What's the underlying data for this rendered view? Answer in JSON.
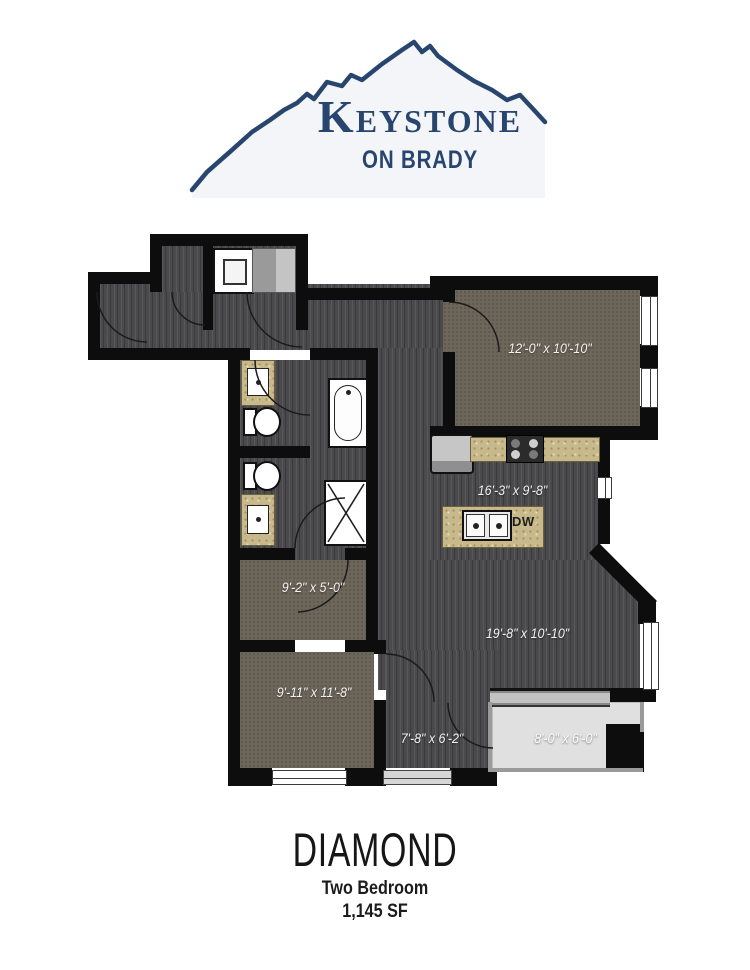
{
  "logo": {
    "name": "Keystone",
    "subtitle": "ON BRADY",
    "mountain_icon": "mountain-outline-icon",
    "brand_color": "#27456e"
  },
  "plan": {
    "rooms": [
      {
        "id": "bedroom-1",
        "dims": "12'-0\" x 10'-10\""
      },
      {
        "id": "kitchen",
        "dims": "16'-3\" x 9'-8\""
      },
      {
        "id": "walk-in-closet",
        "dims": "9'-2\" x 5'-0\""
      },
      {
        "id": "living-room",
        "dims": "19'-8\" x 10'-10\""
      },
      {
        "id": "bedroom-2",
        "dims": "9'-11\" x 11'-8\""
      },
      {
        "id": "entry",
        "dims": "7'-8\" x 6'-2\""
      },
      {
        "id": "balcony",
        "dims": "8'-0\" x 6'-0\""
      }
    ],
    "labels": {
      "dishwasher": "DW"
    }
  },
  "footer": {
    "plan_name": "DIAMOND",
    "bedrooms": "Two Bedroom",
    "area": "1,145 SF"
  },
  "colors": {
    "brand_navy": "#27456e",
    "wall": "#0d0d0d",
    "wood_floor": "#4a4a4d",
    "carpet": "#6d665a",
    "counter_granite": "#c8b98c",
    "balcony_floor": "#e0e0e0"
  }
}
